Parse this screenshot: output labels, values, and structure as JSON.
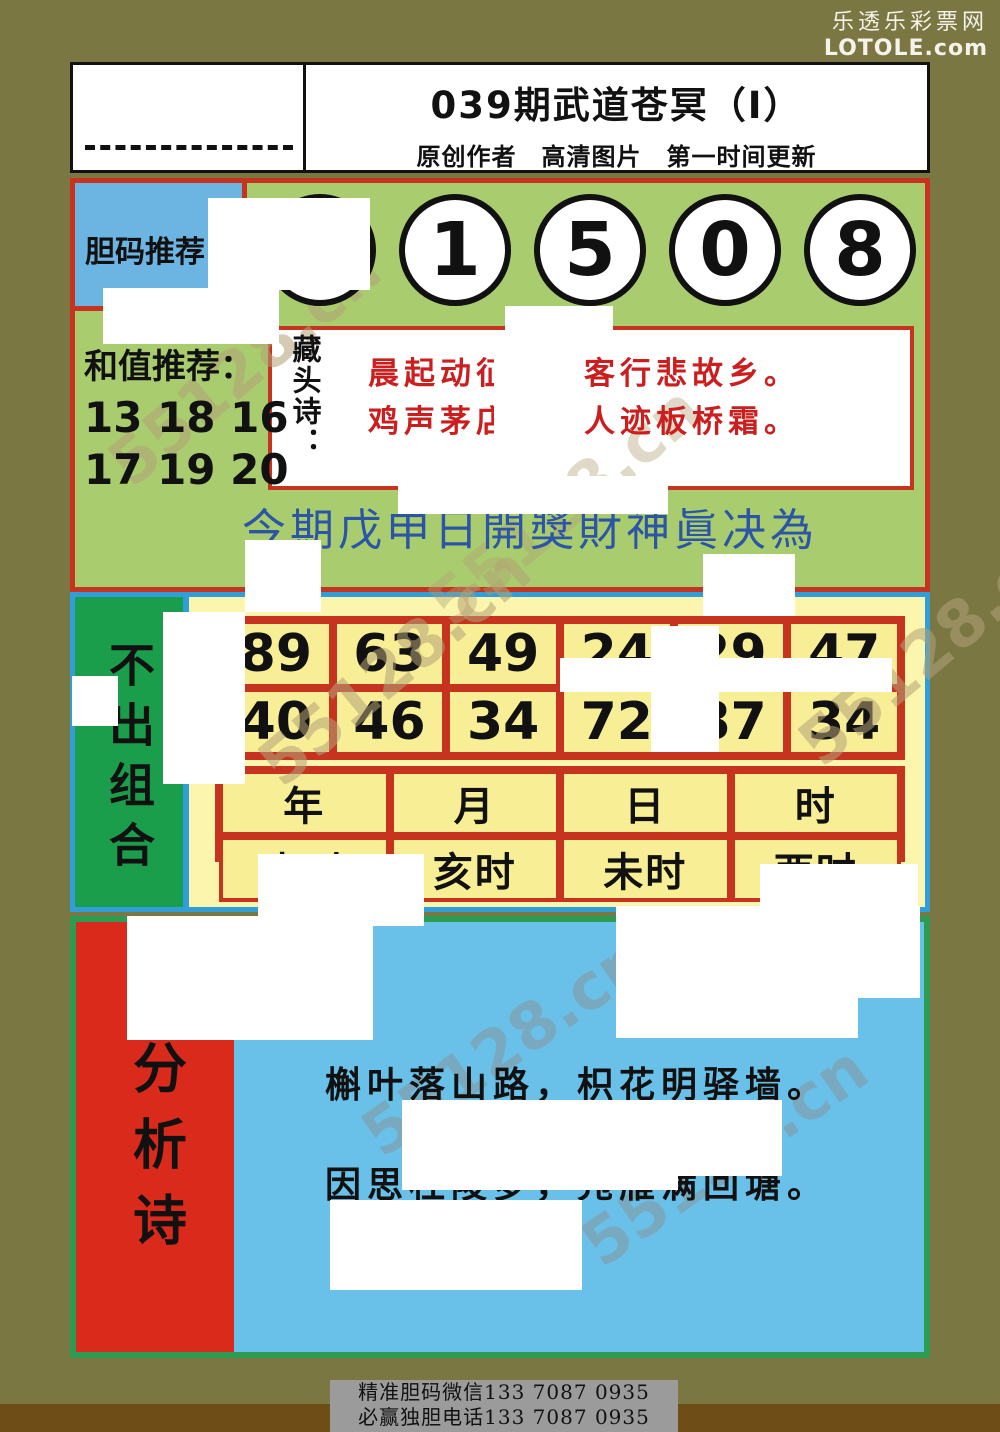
{
  "site": {
    "name": "乐透乐彩票网",
    "domain": "LOTOLE.com"
  },
  "header": {
    "title": "039期武道苍冥（I）",
    "subtitle": "原创作者　高清图片　第一时间更新"
  },
  "danma": {
    "label": "胆码推荐",
    "numbers": [
      "7",
      "1",
      "5",
      "0",
      "8"
    ]
  },
  "hezhi": {
    "label": "和值推荐：",
    "values_line1": "13 18 16",
    "values_line2": "17 19 20"
  },
  "cangtou": {
    "label": "藏头诗：",
    "line1": "晨起动征铎，客行悲故乡。",
    "line2": "鸡声茅店月，人迹板桥霜。"
  },
  "calligraphy": {
    "text": "今期戊申日開獎財神眞决為"
  },
  "buchu": {
    "label": "不出组合",
    "row1": [
      "89",
      "63",
      "49",
      "24",
      "29",
      "47"
    ],
    "row2": [
      "40",
      "46",
      "34",
      "72",
      "87",
      "34"
    ],
    "period_headers": [
      "年",
      "月",
      "日",
      "时"
    ],
    "period_values": [
      "申时",
      "亥时",
      "未时",
      "酉时"
    ]
  },
  "fenxi": {
    "label": "分析诗",
    "line1": "槲叶落山路，枳花明驿墙。",
    "line2": "因思杜陵梦，凫雁满回塘。"
  },
  "footer": {
    "line1": "精准胆码微信133 7087 0935",
    "line2": "必赢独胆电话133 7087 0935"
  },
  "watermark": {
    "text": "55128.cn"
  },
  "colors": {
    "page_bg": "#7b7743",
    "section_green": "#a9cd6e",
    "red_border": "#c63420",
    "blue_label": "#6cb5e2",
    "calligraphy_blue": "#2c55a5",
    "poem_red": "#cb1e1e",
    "sec2_border": "#2f9ed9",
    "green_label": "#1a9e4b",
    "yellow_panel": "#fbf5ad",
    "yellow_cell": "#f7ee96",
    "sec3_border": "#2e9b52",
    "sec3_bg": "#69c1ea",
    "red_label": "#da2a1b",
    "footer_bar": "#9b9b9b",
    "footer_strip": "#6f4d16"
  }
}
